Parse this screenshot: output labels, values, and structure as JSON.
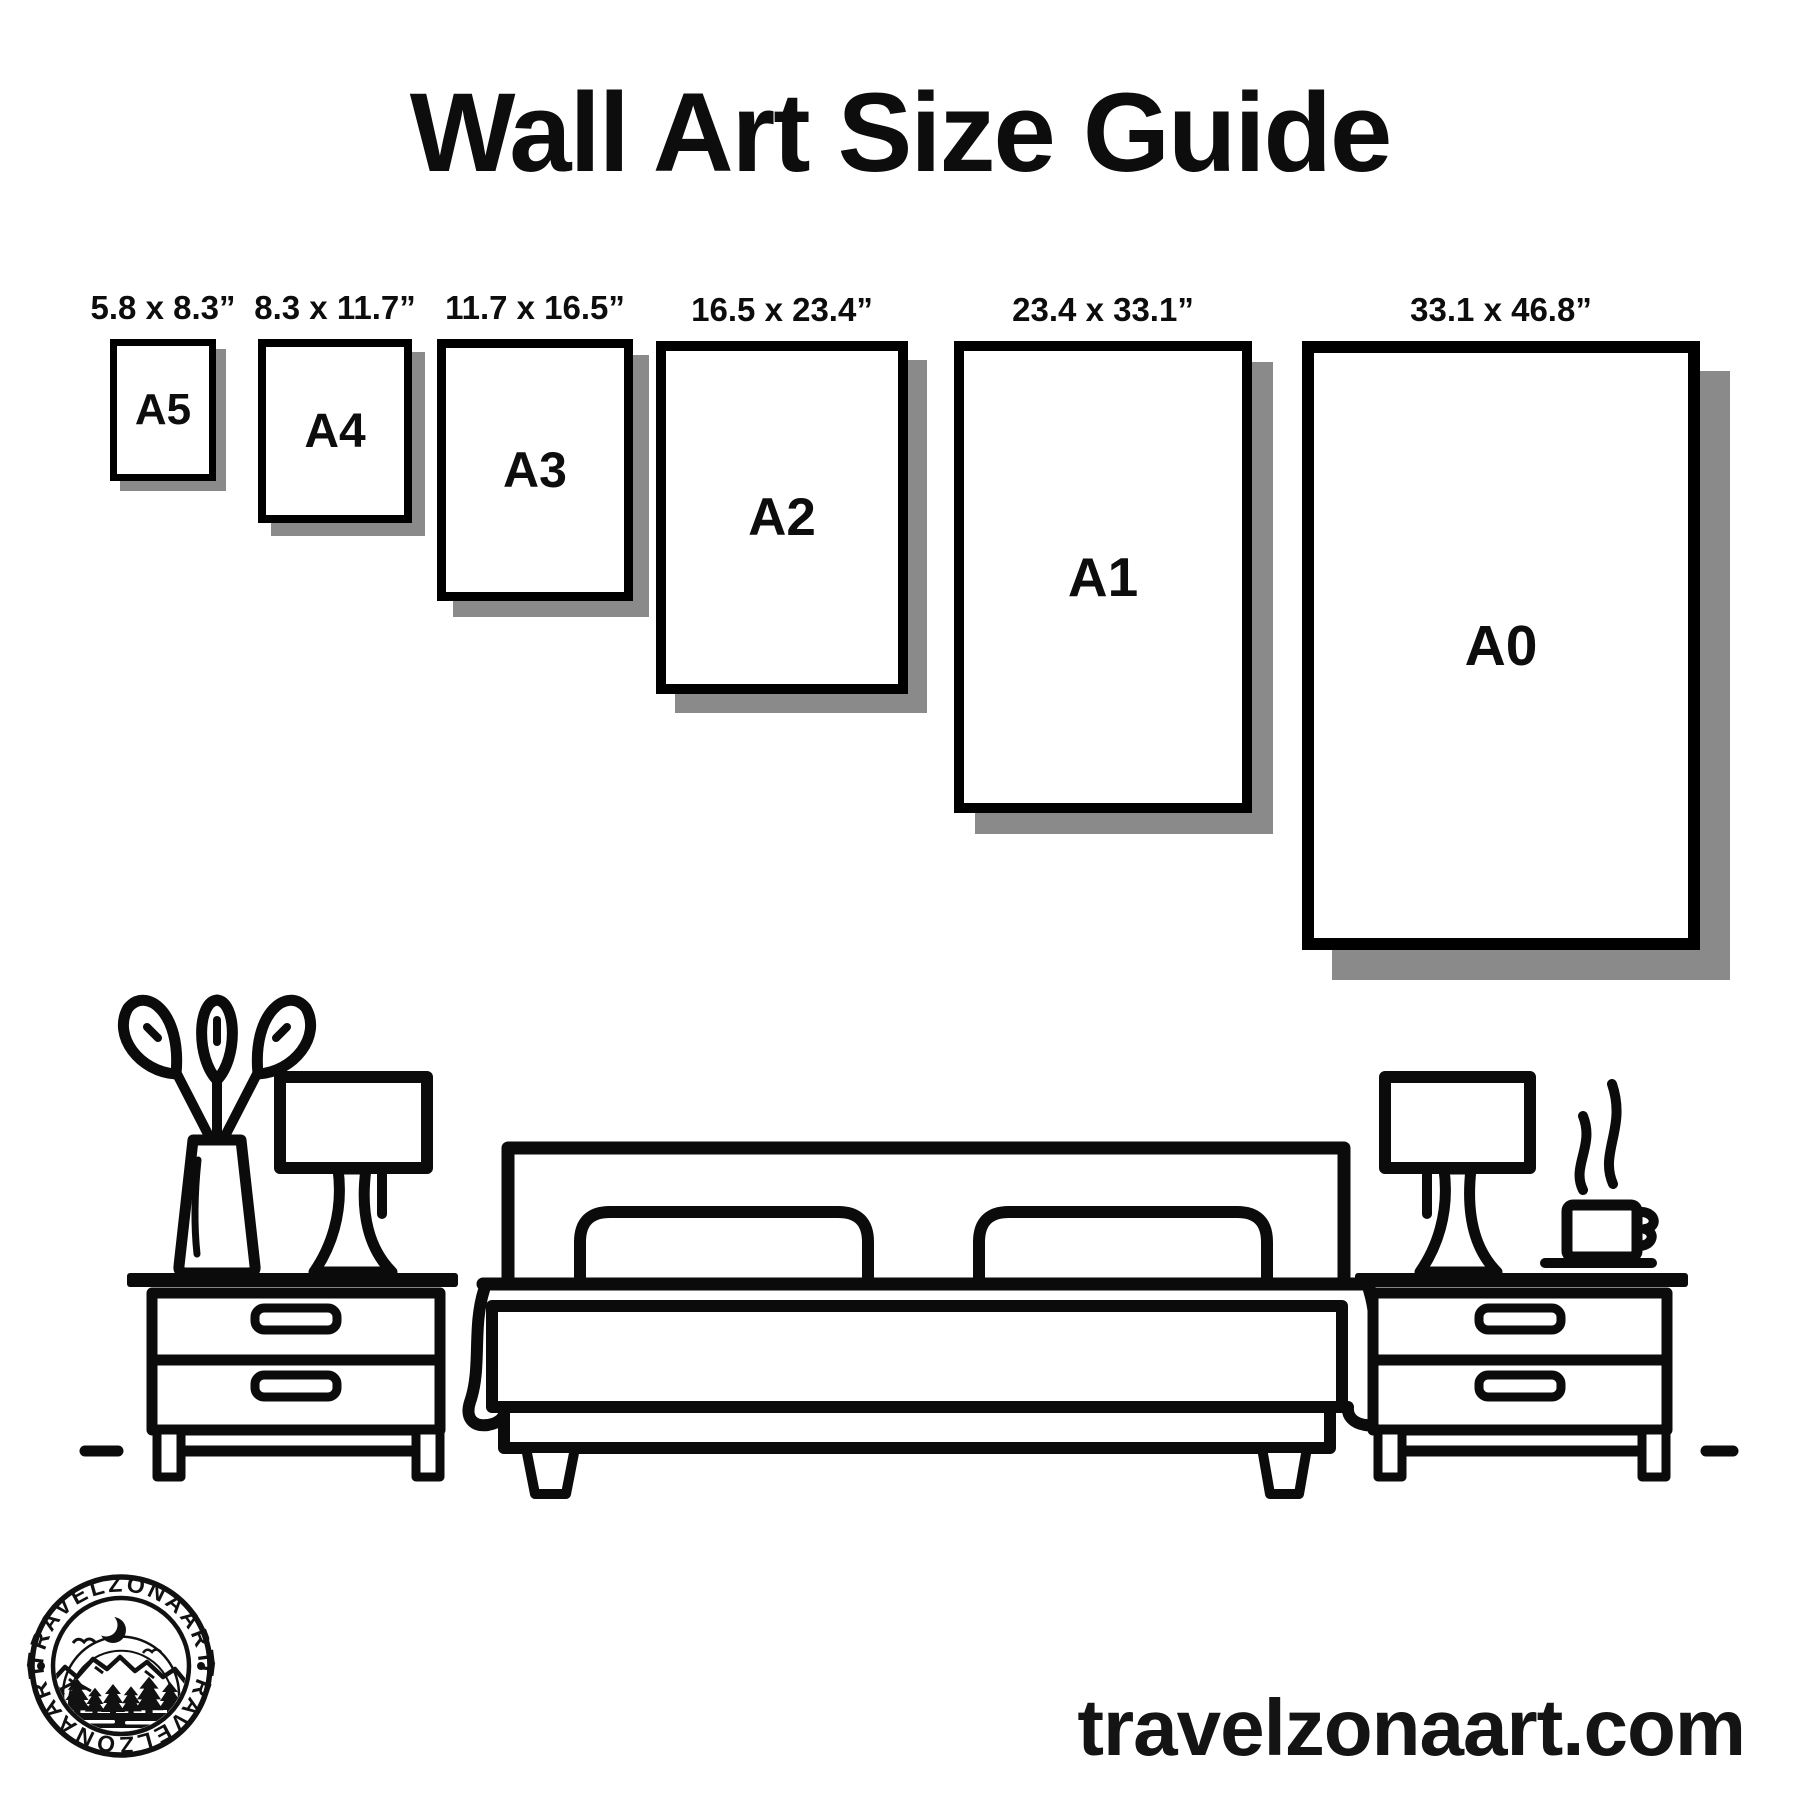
{
  "title": "Wall Art Size Guide",
  "frames": [
    {
      "name": "A5",
      "dimensions": "5.8 x 8.3”"
    },
    {
      "name": "A4",
      "dimensions": "8.3 x 11.7”"
    },
    {
      "name": "A3",
      "dimensions": "11.7 x 16.5”"
    },
    {
      "name": "A2",
      "dimensions": "16.5 x 23.4”"
    },
    {
      "name": "A1",
      "dimensions": "23.4 x 33.1”"
    },
    {
      "name": "A0",
      "dimensions": "33.1 x 46.8”"
    }
  ],
  "logo": {
    "brand": "TRAVELZONAART"
  },
  "website": "travelzonaart.com",
  "colors": {
    "ink": "#0b0b0b",
    "shadow": "#8a8a8a",
    "background": "#ffffff"
  }
}
